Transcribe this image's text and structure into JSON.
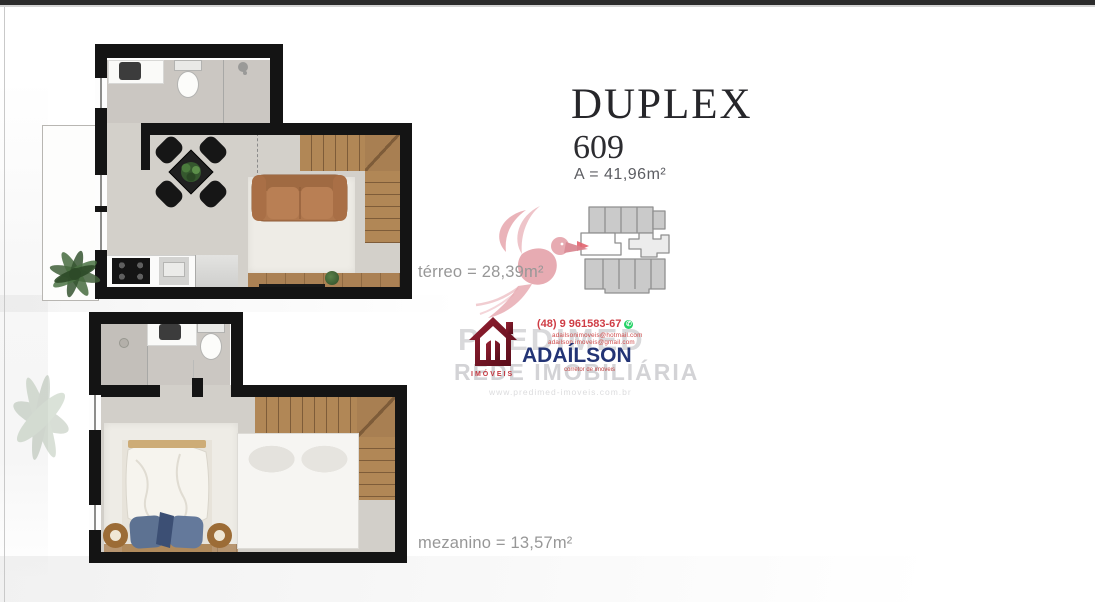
{
  "header": {
    "title": "DUPLEX",
    "unit": "609",
    "area": "A = 41,96m²"
  },
  "plans": {
    "terreo": {
      "label": "térreo = 28,39m²"
    },
    "mezanino": {
      "label": "mezanino = 13,57m²"
    }
  },
  "watermark": {
    "brand": "PREDIMED",
    "network": "REDE IMOBILIÁRIA",
    "logo_caption": "IMÓVEIS",
    "agent": "ADAÍLSON",
    "agent_role": "corretor de imóveis",
    "phone": "(48) 9 961583-67",
    "contact_line1": "adailsonimoveis@hotmail.com",
    "contact_line2": "adailson.imoveis@gmail.com",
    "website": "www.predimed-imoveis.com.br"
  },
  "icons": {
    "whatsapp": "✆"
  },
  "colors": {
    "wall": "#141414",
    "floor": "#d3d0ca",
    "wood": "#ab8154",
    "sofa": "#b0774d",
    "pillow_blue": "#5d7292",
    "watermark_pink": "#e5a2aa",
    "keyplan_arrow_red": "#e2636e",
    "brand_gray": "#d9d9db",
    "agent_navy": "#233475",
    "contact_red": "#cf3d45",
    "logo_maroon": "#7c1626",
    "keyplan_gray": "#cacaca"
  }
}
